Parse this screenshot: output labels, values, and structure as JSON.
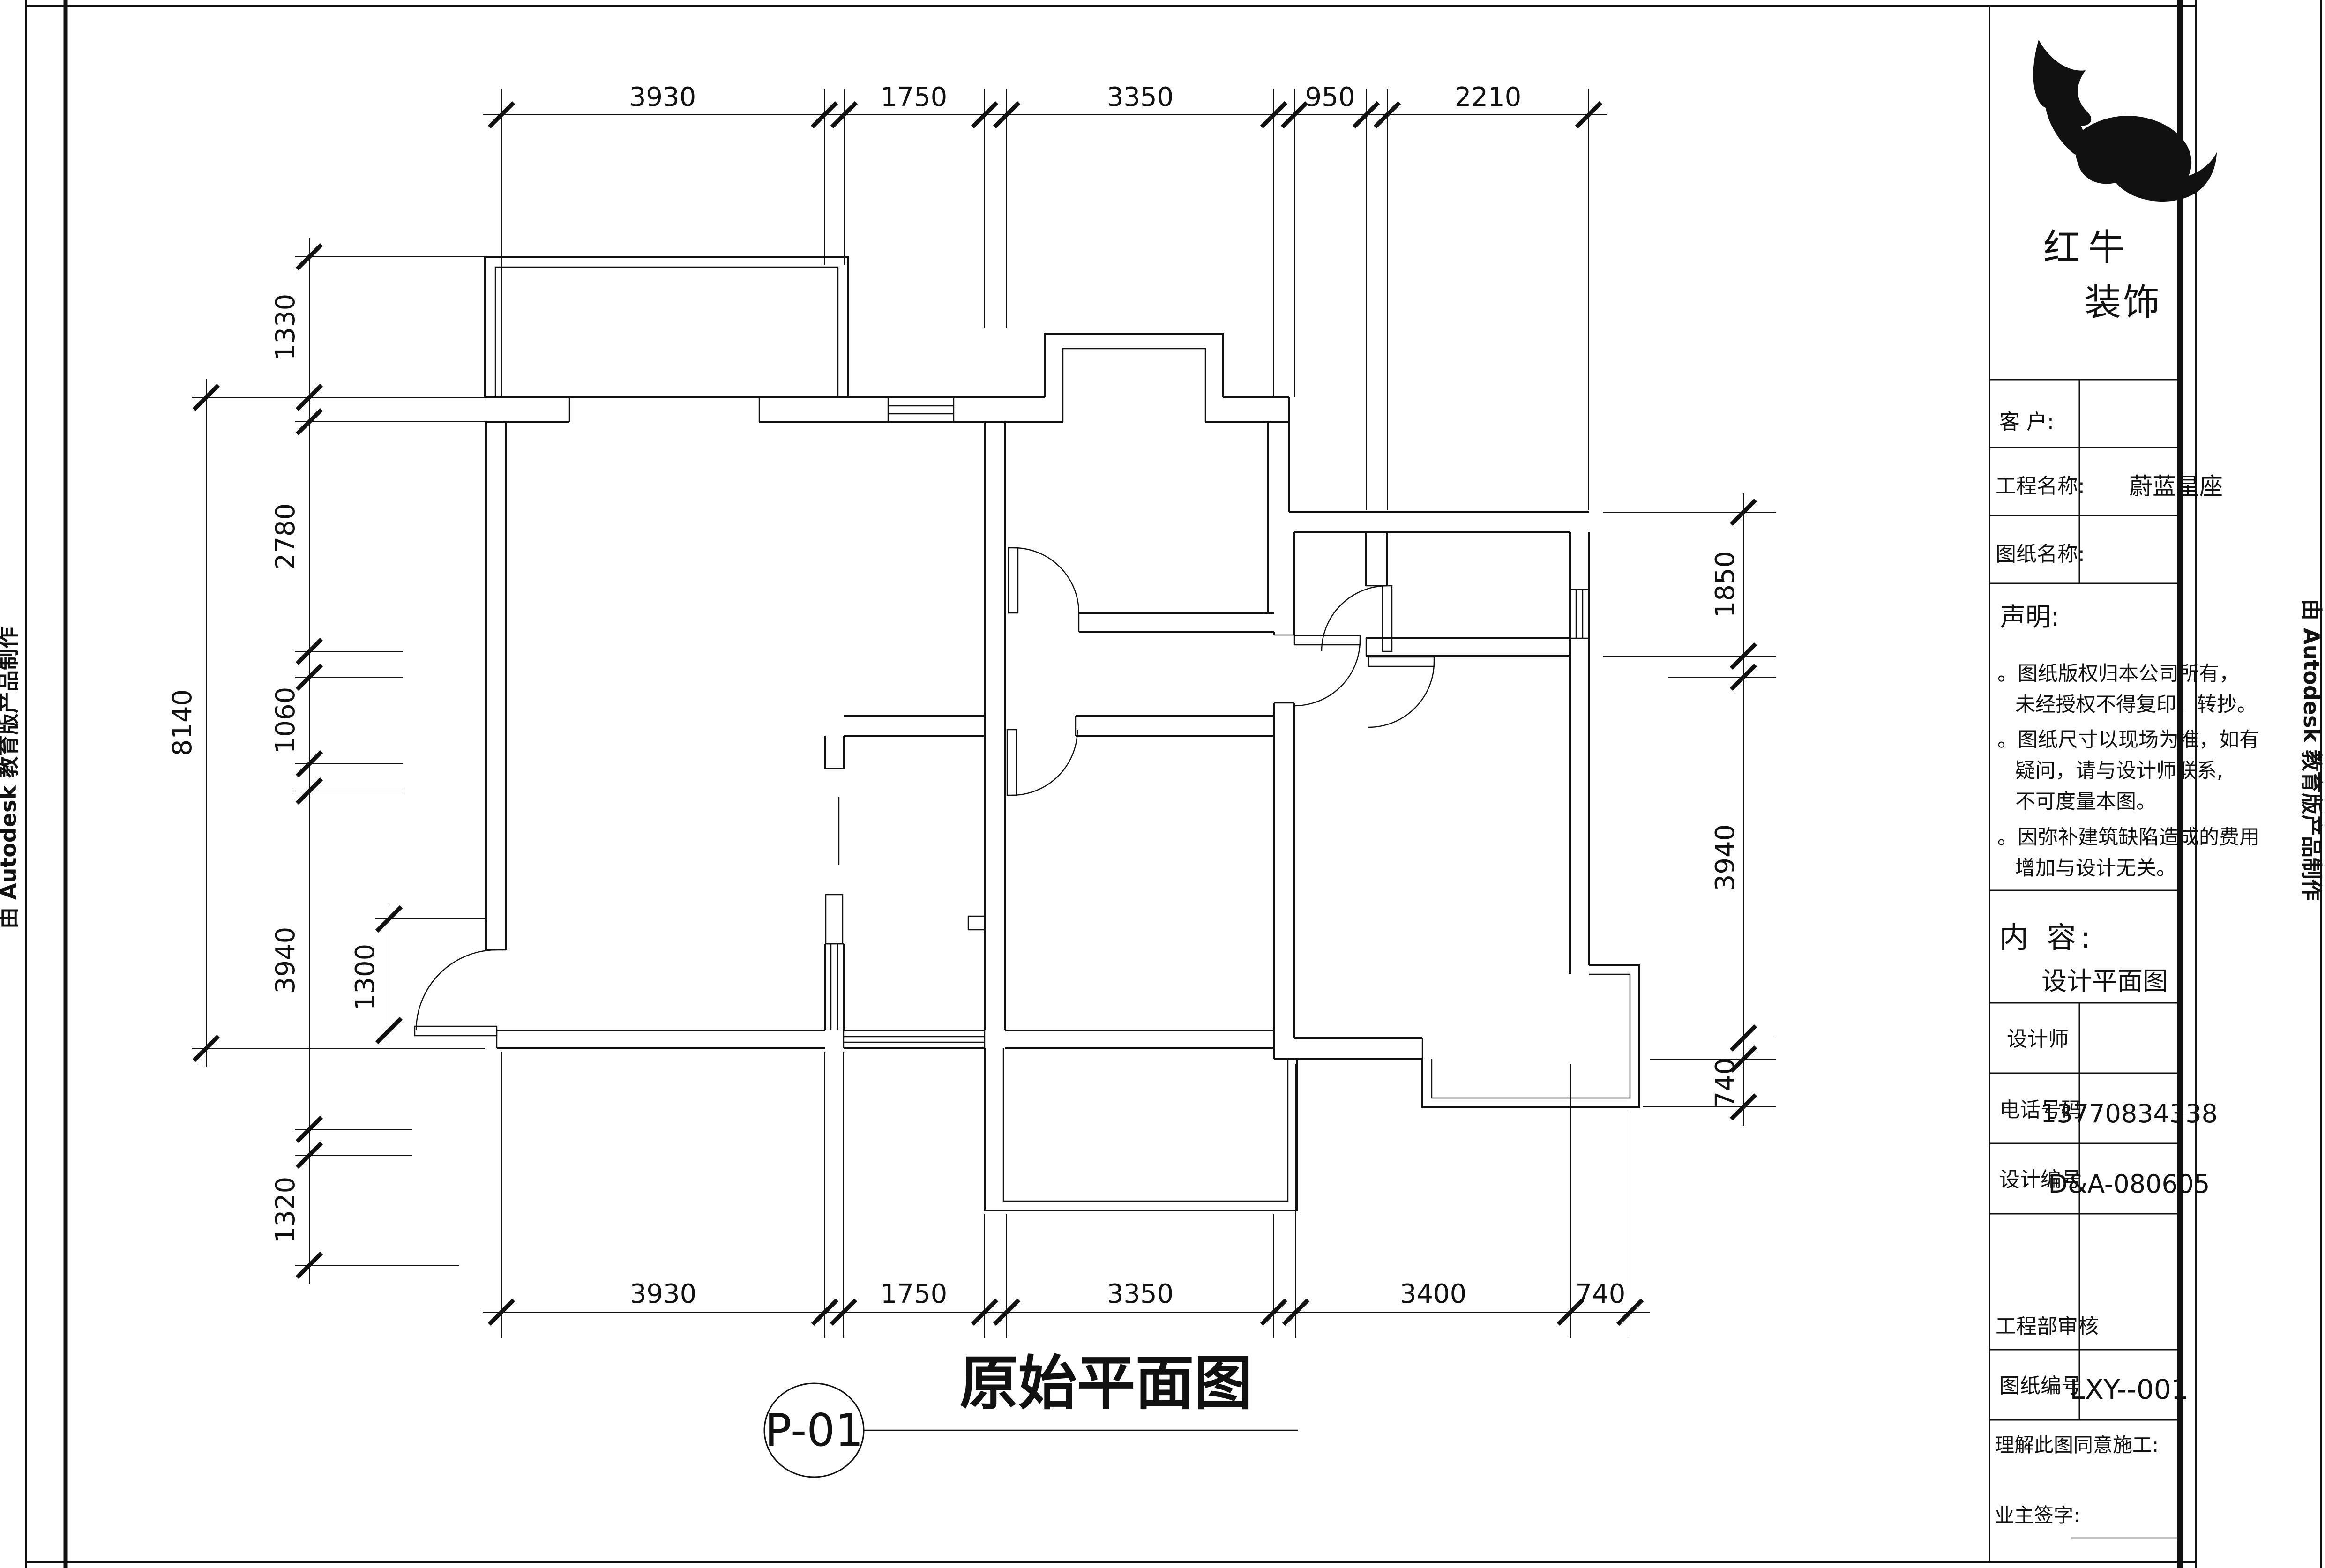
{
  "sheet": {
    "edge_note_left": "由 Autodesk 教育版产品制作",
    "edge_note_right": "由 Autodesk 教育版产品制作"
  },
  "drawing": {
    "label_code": "P-01",
    "title": "原始平面图"
  },
  "dims": {
    "top": [
      "3930",
      "1750",
      "3350",
      "950",
      "2210"
    ],
    "bottom": [
      "3930",
      "1750",
      "3350",
      "3400",
      "740"
    ],
    "left_outer": "8140",
    "left_inner": [
      "1330",
      "2780",
      "1060",
      "3940",
      "1320"
    ],
    "left_extra": "1300",
    "right": [
      "1850",
      "3940",
      "740"
    ]
  },
  "title_block": {
    "brand": {
      "line1": "红牛",
      "line2": "装饰"
    },
    "rows": [
      {
        "label": "客  户:",
        "value": ""
      },
      {
        "label": "工程名称:",
        "value": "蔚蓝星座"
      },
      {
        "label": "图纸名称:",
        "value": ""
      }
    ],
    "statement": {
      "heading": "声明:",
      "lines": [
        "。图纸版权归本公司所有，",
        "未经授权不得复印、转抄。",
        "。图纸尺寸以现场为准，如有",
        "疑问，请与设计师联系,",
        "不可度量本图。",
        "。因弥补建筑缺陷造成的费用",
        "增加与设计无关。"
      ]
    },
    "content": {
      "heading": "内 容:",
      "value": "设计平面图"
    },
    "info_rows": [
      {
        "label": "设计师",
        "value": ""
      },
      {
        "label": "电话号码",
        "value": "13770834338"
      },
      {
        "label": "设计编号",
        "value": "D&A-080605"
      },
      {
        "label": "工程部审核",
        "value": ""
      },
      {
        "label": "图纸编号",
        "value": "LXY--001"
      }
    ],
    "footer": {
      "line1": "理解此图同意施工:",
      "line2": "业主签字:"
    }
  }
}
